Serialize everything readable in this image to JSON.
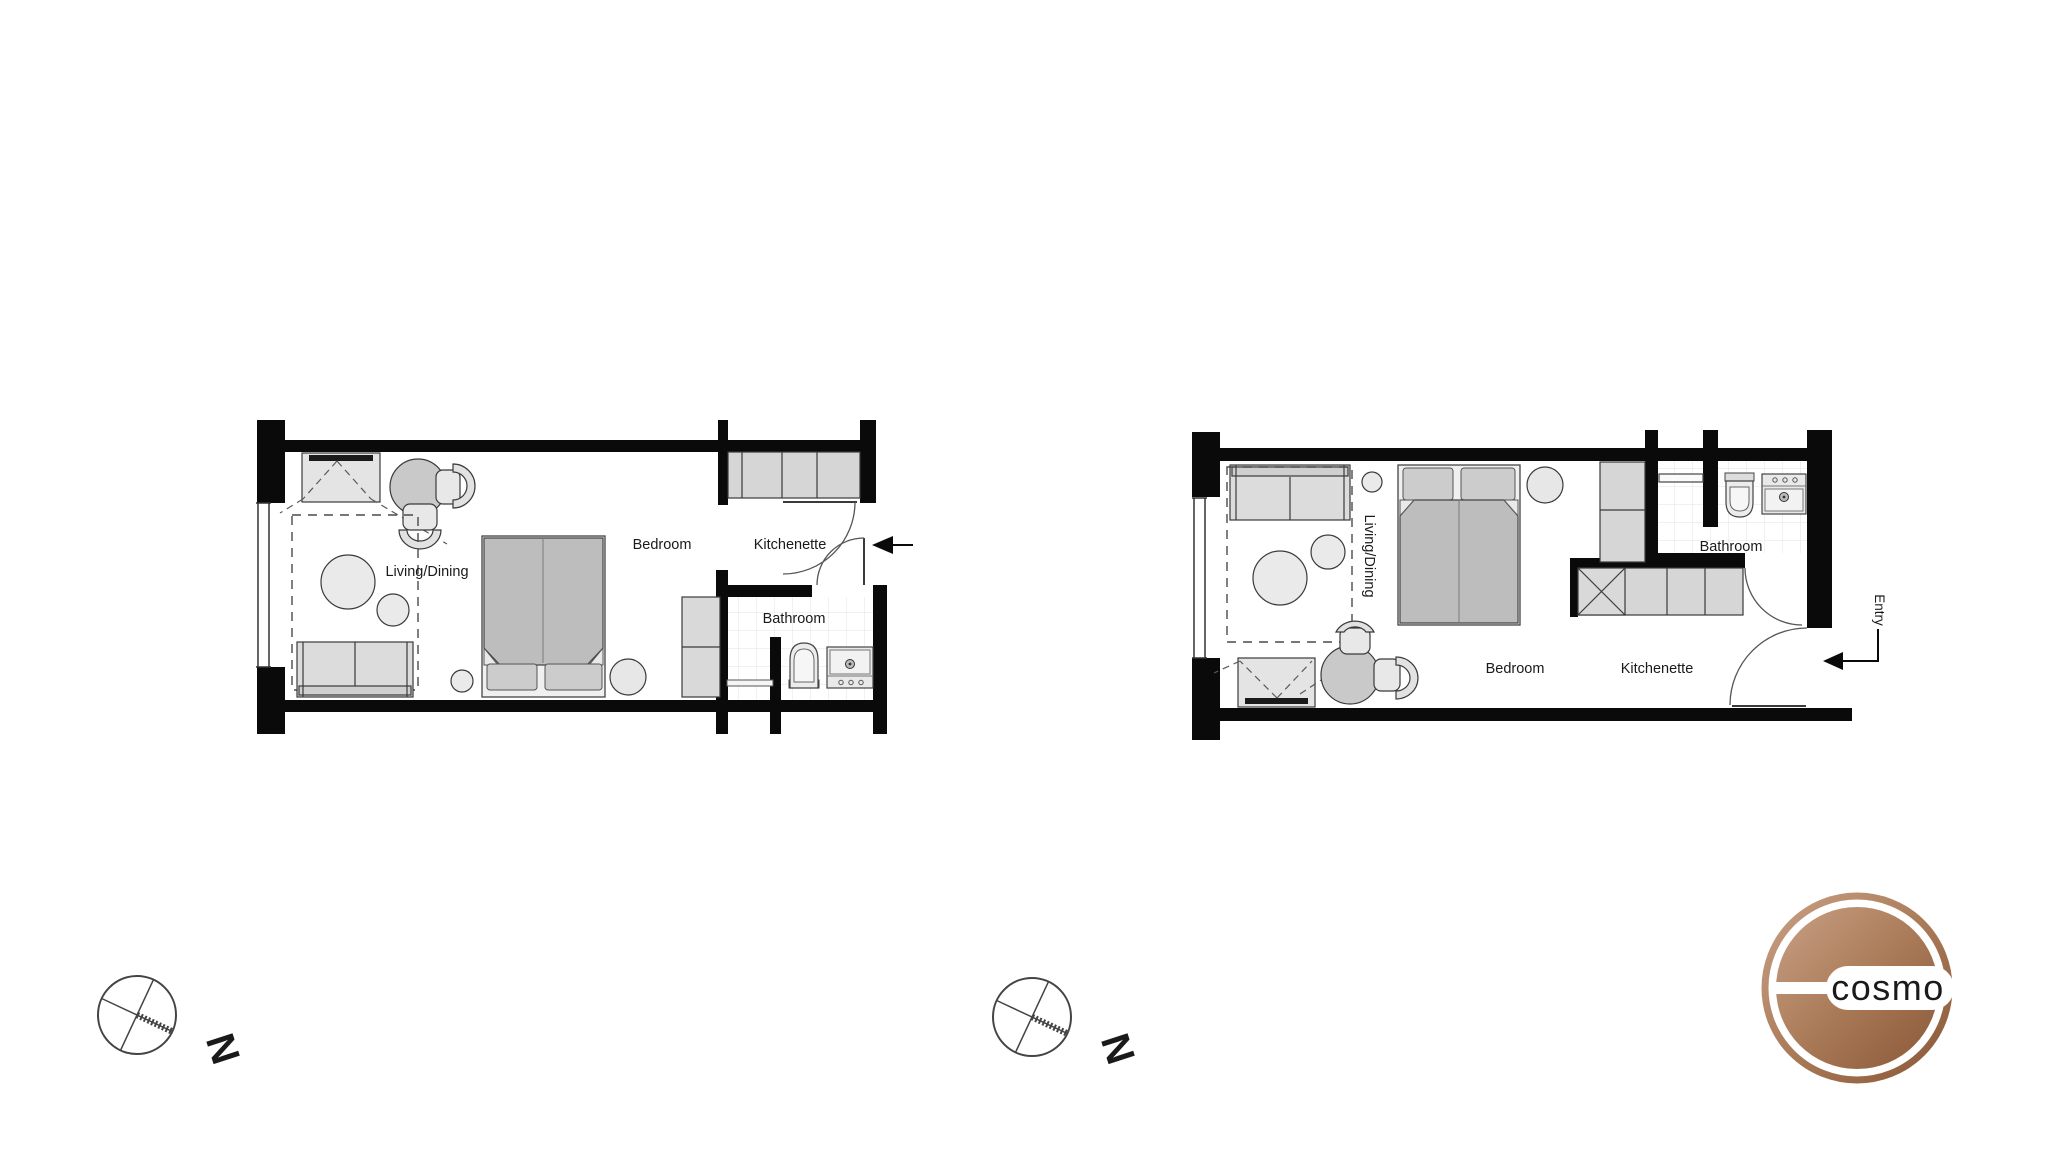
{
  "plans": {
    "left": {
      "living_dining": "Living/Dining",
      "bedroom": "Bedroom",
      "kitchenette": "Kitchenette",
      "bathroom": "Bathroom"
    },
    "right": {
      "living_dining": "Living/Dining",
      "bedroom": "Bedroom",
      "kitchenette": "Kitchenette",
      "bathroom": "Bathroom",
      "entry": "Entry"
    }
  },
  "compass": {
    "north_label": "N"
  },
  "logo": {
    "brand": "cosmo",
    "copper_light": "#c9a086",
    "copper_mid": "#aa7b58",
    "copper_dark": "#8a5838",
    "text_color": "#9a6a48"
  },
  "colors": {
    "wall": "#0a0a0a",
    "furniture_light": "#eaeaea",
    "furniture_mid": "#d6d6d6",
    "bed_duvet": "#bdbdbd",
    "seat_dark": "#c9c9c9",
    "tile_line": "#e3e3e3",
    "background": "#ffffff"
  }
}
